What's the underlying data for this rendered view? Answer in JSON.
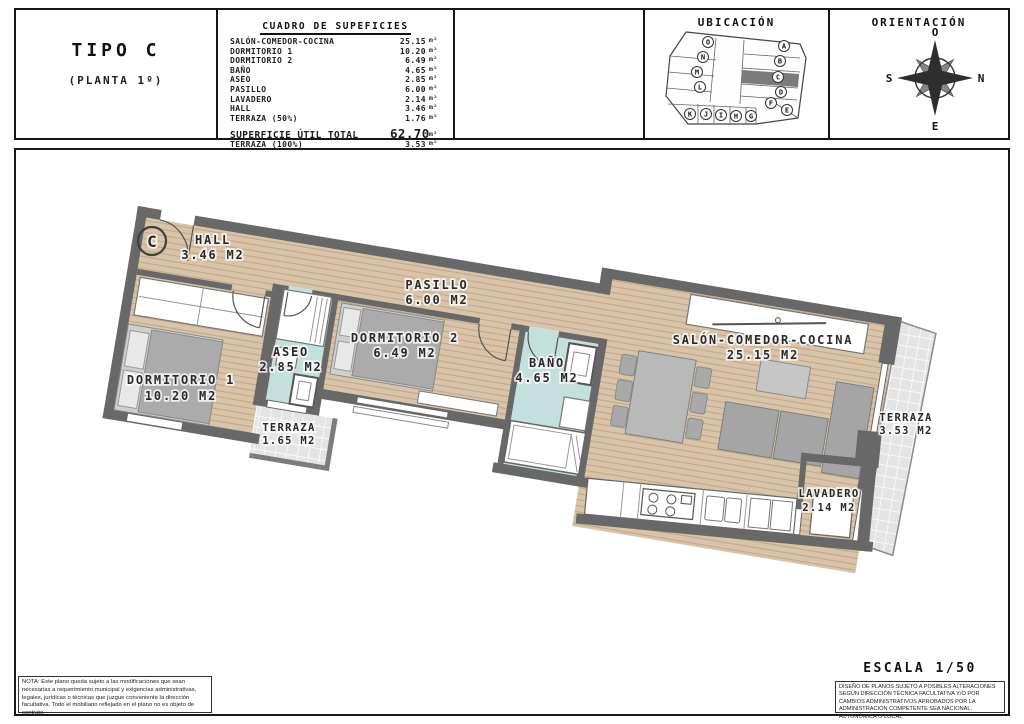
{
  "header": {
    "tipo": {
      "title": "TIPO C",
      "subtitle": "(PLANTA 1º)"
    },
    "cuadro": {
      "title": "CUADRO DE SUPEFICIES",
      "rows": [
        {
          "label": "SALÓN-COMEDOR-COCINA",
          "value": "25.15",
          "unit": "m²"
        },
        {
          "label": "DORMITORIO 1",
          "value": "10.20",
          "unit": "m²"
        },
        {
          "label": "DORMITORIO 2",
          "value": "6.49",
          "unit": "m²"
        },
        {
          "label": "BAÑO",
          "value": "4.65",
          "unit": "m²"
        },
        {
          "label": "ASEO",
          "value": "2.85",
          "unit": "m²"
        },
        {
          "label": "PASILLO",
          "value": "6.00",
          "unit": "m²"
        },
        {
          "label": "LAVADERO",
          "value": "2.14",
          "unit": "m²"
        },
        {
          "label": "HALL",
          "value": "3.46",
          "unit": "m²"
        },
        {
          "label": "TERRAZA (50%)",
          "value": "1.76",
          "unit": "m²"
        }
      ],
      "totals": [
        {
          "label": "SUPERFICIE ÚTIL TOTAL",
          "value": "62.70",
          "unit": "m²"
        },
        {
          "label": "TERRAZA (100%)",
          "value": "3.53",
          "unit": "m²"
        }
      ]
    },
    "ubicacion": {
      "title": "UBICACIÓN",
      "highlighted_unit": "C",
      "units": [
        "A",
        "B",
        "C",
        "D",
        "E",
        "F",
        "G",
        "H",
        "I",
        "J",
        "K",
        "L",
        "M",
        "N",
        "O"
      ]
    },
    "orientacion": {
      "title": "ORIENTACIÓN",
      "compass": {
        "top": "O",
        "right": "N",
        "bottom": "E",
        "left": "S"
      }
    }
  },
  "plan": {
    "unit_marker": "C",
    "rooms": {
      "hall": {
        "name": "HALL",
        "area": "3.46 M2"
      },
      "pasillo": {
        "name": "PASILLO",
        "area": "6.00 M2"
      },
      "dormitorio1": {
        "name": "DORMITORIO 1",
        "area": "10.20 M2"
      },
      "dormitorio2": {
        "name": "DORMITORIO 2",
        "area": "6.49 M2"
      },
      "aseo": {
        "name": "ASEO",
        "area": "2.85 M2"
      },
      "bano": {
        "name": "BAÑO",
        "area": "4.65 M2"
      },
      "salon": {
        "name": "SALÓN-COMEDOR-COCINA",
        "area": "25.15 M2"
      },
      "terraza_dormitorio": {
        "name": "TERRAZA",
        "area": "1.65 M2"
      },
      "terraza_salon": {
        "name": "TERRAZA",
        "area": "3.53 M2"
      },
      "lavadero": {
        "name": "LAVADERO",
        "area": "2.14 M2"
      }
    },
    "colors": {
      "wall": "#686868",
      "wood_floor": "#d9c3a9",
      "wet_room": "#c3e0dc",
      "terrace_tile": "#e4e4e4"
    }
  },
  "footer": {
    "nota": "NOTA: Este plano queda sujeto a las modificaciones que sean necesarias a requerimiento municipal y exigencias administrativas, legales, jurídicas o técnicas que juzgue conveniente la dirección facultativa. Todo el mobiliario reflejado en el plano no es objeto de contrato.",
    "escala": "ESCALA 1/50",
    "disclaimer": "DISEÑO DE PLANOS SUJETO A POSIBLES ALTERACIONES SEGÚN DIRECCIÓN TÉCNICA FACULTATIVA Y/O POR CAMBIOS ADMINISTRATIVOS APROBADOS POR LA ADMINISTRACIÓN COMPETENTE SEA NACIONAL, AUTONÓMICA O LOCAL"
  }
}
